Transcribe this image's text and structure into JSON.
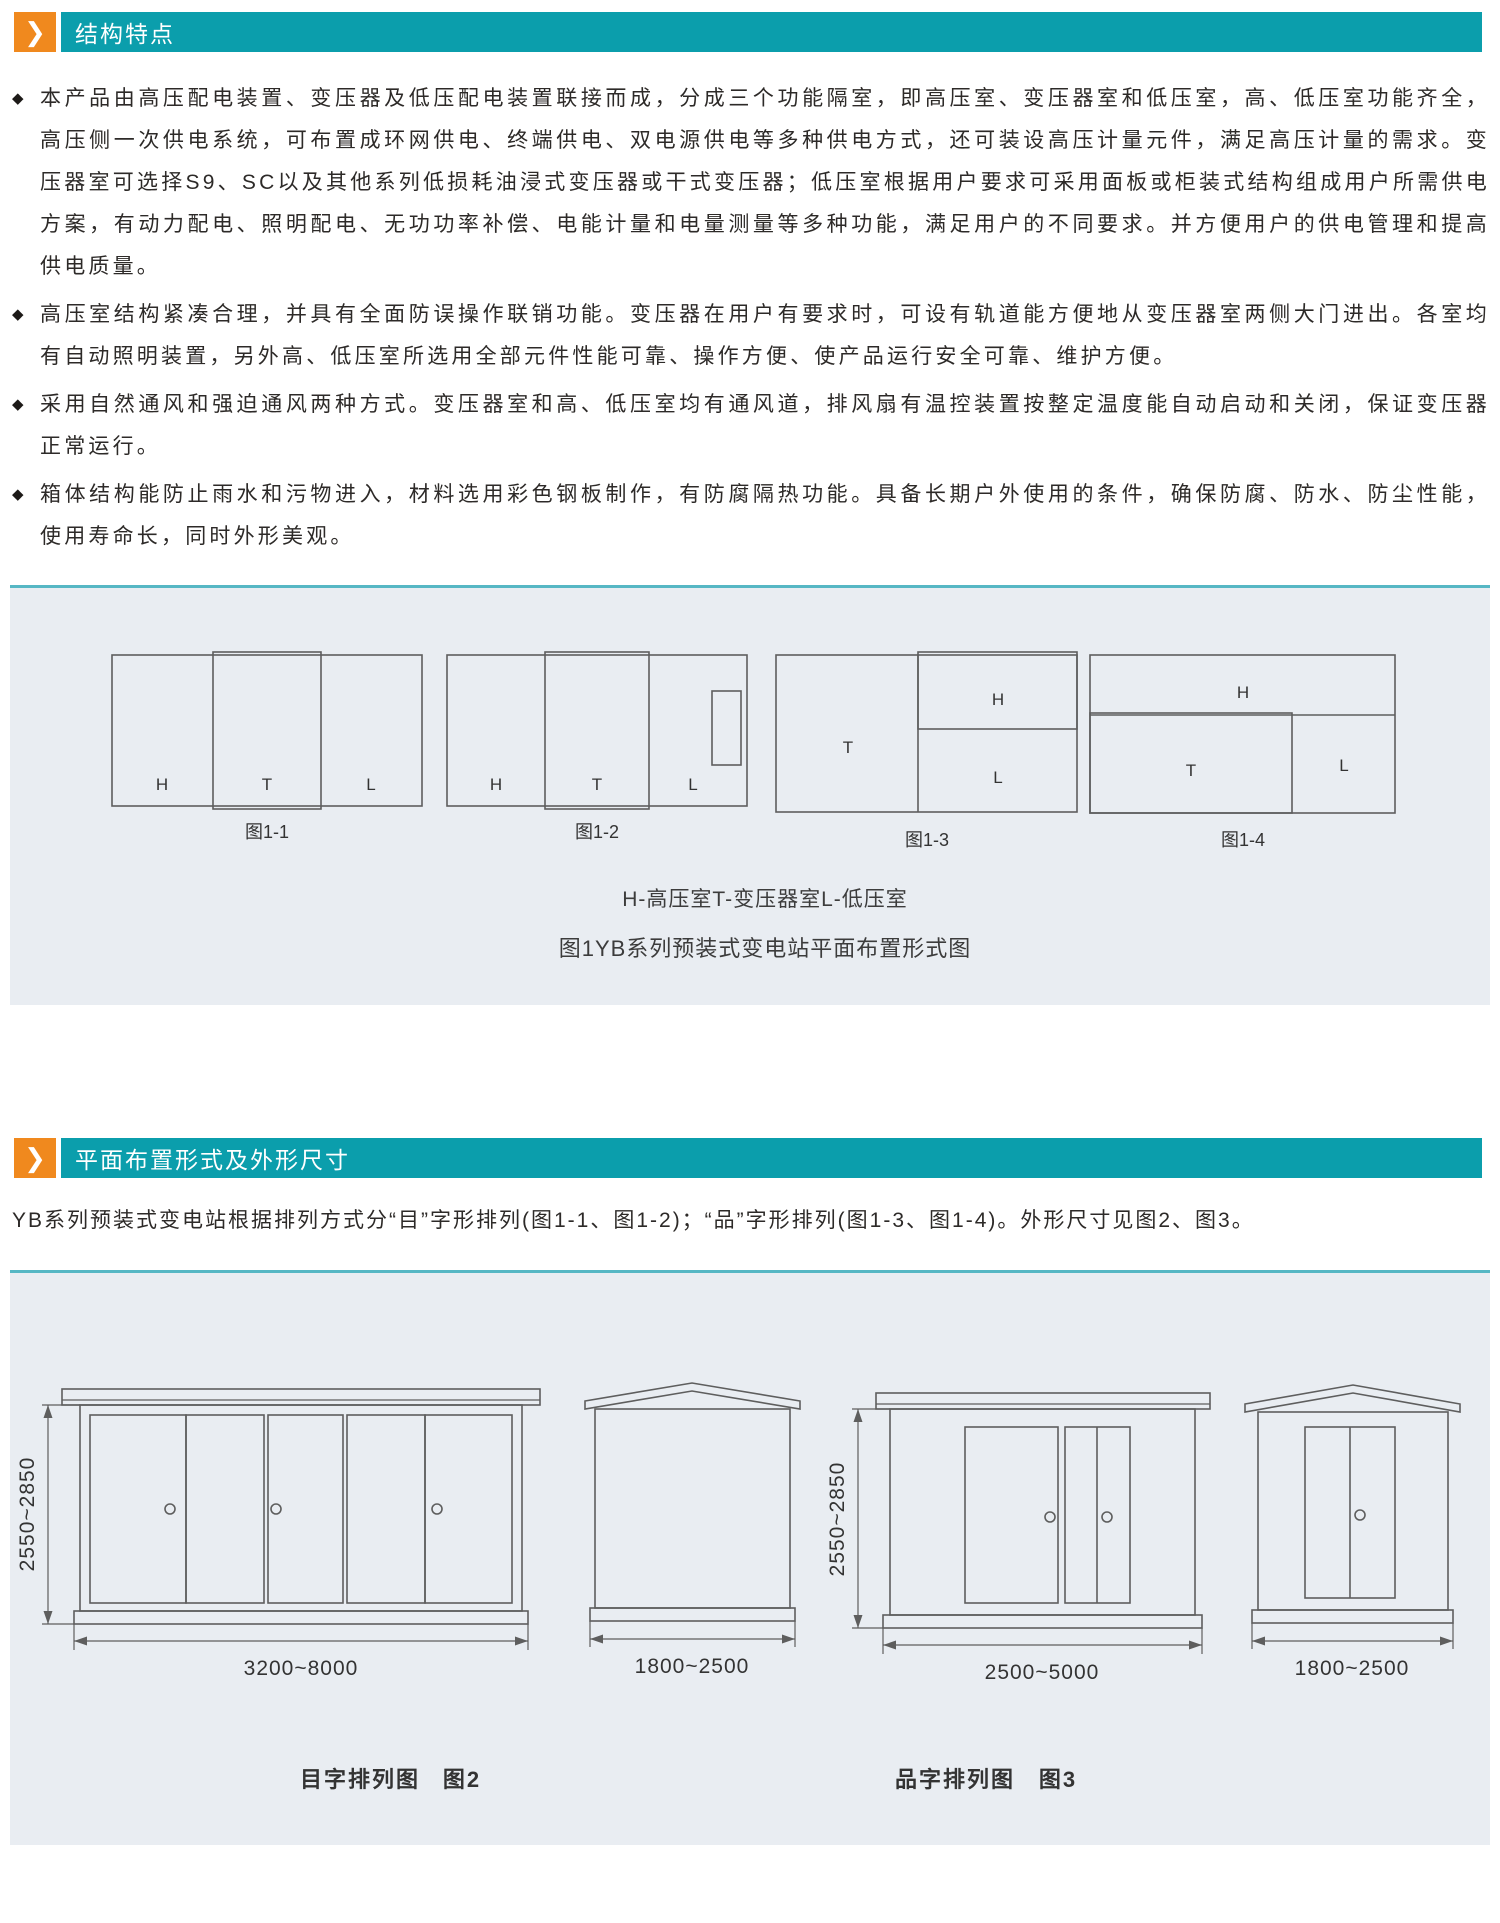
{
  "icons": {
    "chevron": "❯"
  },
  "section1": {
    "title": "结构特点",
    "bullet_marker": "◆",
    "bullets": [
      "本产品由高压配电装置、变压器及低压配电装置联接而成，分成三个功能隔室，即高压室、变压器室和低压室，高、低压室功能齐全，高压侧一次供电系统，可布置成环网供电、终端供电、双电源供电等多种供电方式，还可装设高压计量元件，满足高压计量的需求。变压器室可选择S9、SC以及其他系列低损耗油浸式变压器或干式变压器；低压室根据用户要求可采用面板或柜装式结构组成用户所需供电方案，有动力配电、照明配电、无功功率补偿、电能计量和电量测量等多种功能，满足用户的不同要求。并方便用户的供电管理和提高供电质量。",
      "高压室结构紧凑合理，并具有全面防误操作联销功能。变压器在用户有要求时，可设有轨道能方便地从变压器室两侧大门进出。各室均有自动照明装置，另外高、低压室所选用全部元件性能可靠、操作方便、使产品运行安全可靠、维护方便。",
      "采用自然通风和强迫通风两种方式。变压器室和高、低压室均有通风道，排风扇有温控装置按整定温度能自动启动和关闭，保证变压器正常运行。",
      "箱体结构能防止雨水和污物进入，材料选用彩色钢板制作，有防腐隔热功能。具备长期户外使用的条件，确保防腐、防水、防尘性能，使用寿命长，同时外形美观。"
    ]
  },
  "figure1": {
    "rooms": {
      "h": "H",
      "t": "T",
      "l": "L"
    },
    "captions": [
      "图1-1",
      "图1-2",
      "图1-3",
      "图1-4"
    ],
    "legend": "H-高压室T-变压器室L-低压室",
    "title": "图1YB系列预装式变电站平面布置形式图"
  },
  "section2": {
    "title": "平面布置形式及外形尺寸",
    "paragraph": "YB系列预装式变电站根据排列方式分“目”字形排列(图1-1、图1-2)；“品”字形排列(图1-3、图1-4)。外形尺寸见图2、图3。"
  },
  "figure2": {
    "height_dim": "2550~2850",
    "width_dim": "3200~8000",
    "side_width_dim": "1800~2500",
    "caption": "目字排列图",
    "caption_num": "图2"
  },
  "figure3": {
    "height_dim": "2550~2850",
    "width_dim": "2500~5000",
    "side_width_dim": "1800~2500",
    "caption": "品字排列图",
    "caption_num": "图3"
  }
}
